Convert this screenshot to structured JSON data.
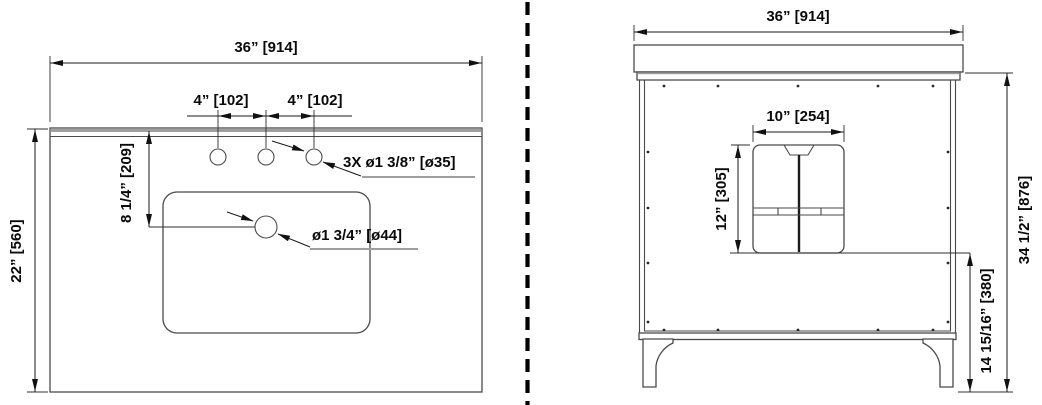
{
  "drawing_type": "vanity dimensional technical drawing",
  "colors": {
    "background": "#ffffff",
    "object_line": "#4a4a4a",
    "dimension_line": "#1a1a1a",
    "accent_gray": "#9e9e9e",
    "divider": "#000000"
  },
  "plan_view": {
    "width_label": "36” [914]",
    "depth_label": "22” [560]",
    "hole_spacing_left_label": "4” [102]",
    "hole_spacing_right_label": "4” [102]",
    "drain_offset_label": "8 1/4” [209]",
    "faucet_holes_label": "3X ø1 3/8” [ø35]",
    "drain_label": "ø1 3/4” [ø44]",
    "faucet_hole_count": 3
  },
  "elevation_view": {
    "width_label": "36” [914]",
    "cutout_width_label": "10” [254]",
    "cutout_height_label": "12” [305]",
    "cutout_floor_offset_label": "14 15/16” [380]",
    "overall_height_label": "34 1/2” [876]"
  }
}
